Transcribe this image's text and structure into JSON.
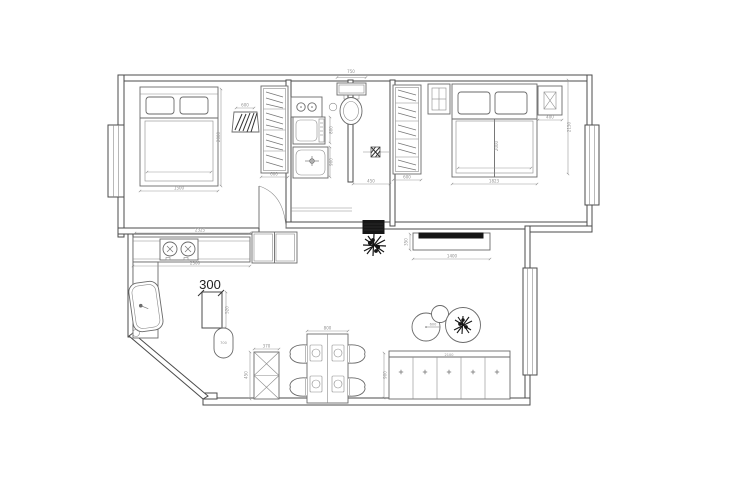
{
  "drawing": {
    "type": "apartment-floor-plan",
    "annotation_label": "300",
    "capsule_label": "700",
    "colors": {
      "background": "#ffffff",
      "wall_line": "#4b4b4b",
      "furniture_line": "#6a6a6a",
      "dimension_text": "#8f8f8f",
      "solid_wall_fill": "#161616"
    },
    "dims": {
      "counter_top": "2325",
      "counter_bottom": "2300",
      "bed1_width": "1500",
      "bed1_length": "2000",
      "stool_width": "600",
      "wardrobe1_width": "600",
      "washer_depth": "800",
      "shower_depth": "900",
      "toilet_width": "750",
      "hall_width": "450",
      "wardrobe2_width": "600",
      "bed2_length": "2000",
      "bed2_width": "1823",
      "nightstand_width": "400",
      "bedroom2_depth": "2150",
      "tv_cabinet_width": "1400",
      "tv_cabinet_depth": "350",
      "table_radius": "600",
      "sideboard_width": "2100",
      "dining_table_width": "800",
      "dining_depth": "900",
      "cabinet_depth": "450",
      "cabinet_width": "370",
      "column_width": "520"
    }
  }
}
